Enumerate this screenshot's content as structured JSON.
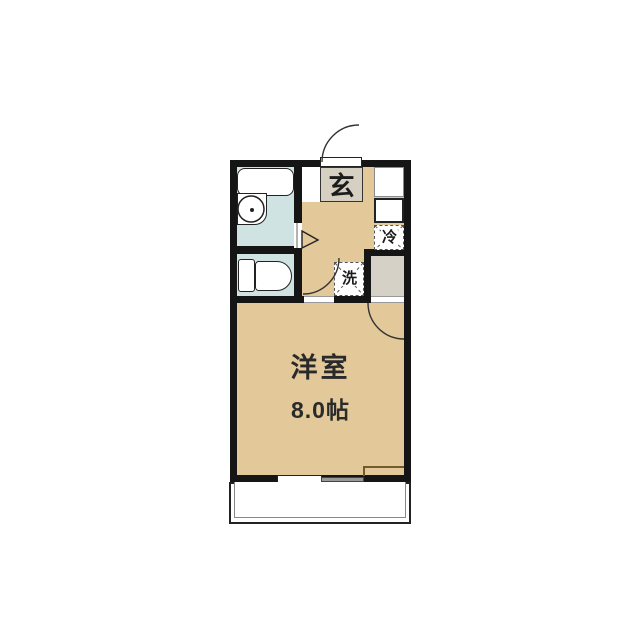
{
  "floor_plan": {
    "entrance": {
      "label": "玄"
    },
    "kitchen_side": {
      "refrigerator_label": "冷"
    },
    "laundry": {
      "washer_label": "洗"
    },
    "main_room": {
      "name": "洋室",
      "size": "8.0帖"
    },
    "colors": {
      "floor_tan": "#e3c89a",
      "wet_area_blue": "#cfe3e3",
      "entrance_gray": "#d5d0c2",
      "closet_gray": "#d5d1c7",
      "wall_black": "#151515",
      "step_olive": "#6f5c28",
      "window_gray": "#999999"
    }
  }
}
